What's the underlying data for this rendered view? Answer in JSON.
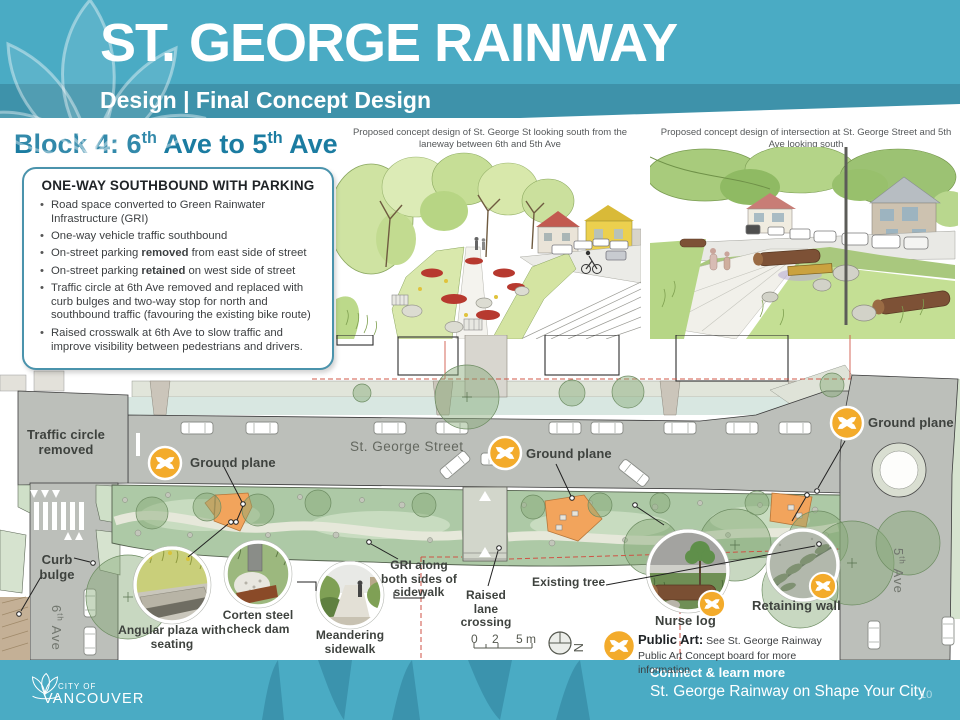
{
  "meta": {
    "page_number": "10"
  },
  "header": {
    "title": "ST. GEORGE RAINWAY",
    "subtitle": "Design | Final Concept Design"
  },
  "block": {
    "heading": {
      "p1": "Block 4: 6",
      "s1": "th",
      "p2": " Ave to 5",
      "s2": "th",
      "p3": " Ave"
    },
    "box_title": "ONE-WAY SOUTHBOUND WITH PARKING",
    "bullets": [
      {
        "text": "Road space converted to Green Rainwater Infrastructure (GRI)"
      },
      {
        "text": "One-way vehicle traffic southbound"
      },
      {
        "pre": "On-street parking ",
        "bold": "removed",
        "post": " from east side of street"
      },
      {
        "pre": "On-street parking ",
        "bold": "retained",
        "post": " on west side of street"
      },
      {
        "text": "Traffic circle at 6th Ave removed and replaced with curb bulges and two-way stop for north and southbound traffic (favouring the existing bike route)"
      },
      {
        "text": "Raised crosswalk at 6th Ave to slow traffic and improve visibility between pedestrians and drivers."
      }
    ]
  },
  "sketches": {
    "left_caption": "Proposed concept design of St. George St looking south from the laneway between 6th and 5th Ave",
    "right_caption": "Proposed concept design of intersection at St. George Street and 5th Ave looking south"
  },
  "plan": {
    "traffic_circle_removed": "Traffic circle removed",
    "street_name": "St. George Street",
    "ground_plane": "Ground plane",
    "curb_bulge": "Curb bulge",
    "sixth_ave": {
      "n": "6",
      "s": "th",
      "rest": " Ave"
    },
    "fifth_ave": {
      "n": "5",
      "s": "th",
      "rest": " Ave"
    },
    "gri_label": "GRI along both sides of sidewalk",
    "raised_lane": "Raised lane crossing",
    "existing_tree": "Existing tree",
    "angular_plaza": "Angular plaza with seating",
    "corten": "Corten steel check dam",
    "meandering": "Meandering sidewalk",
    "nurse_log": "Nurse log",
    "retaining_wall": "Retaining wall",
    "public_art_label": "Public Art:",
    "public_art_text": "See St. George Rainway Public Art Concept board for more information",
    "scale": {
      "zero": "0",
      "two": "2",
      "five": "5 m"
    },
    "north": "N"
  },
  "footer": {
    "connect": "Connect & learn more",
    "link": "St. George Rainway on Shape Your City",
    "logo_line1": "CITY OF",
    "logo_line2": "VANCOUVER"
  },
  "colors": {
    "header_teal": "#4aabc4",
    "band_teal": "#3e92aa",
    "heading_text": "#1b7ca1",
    "icon_orange": "#f3ab2b",
    "plaza_orange": "#f2a45c",
    "road_gray": "#bcbfba",
    "gri_green": "#adc9a6",
    "red_dash": "#cf5244"
  }
}
